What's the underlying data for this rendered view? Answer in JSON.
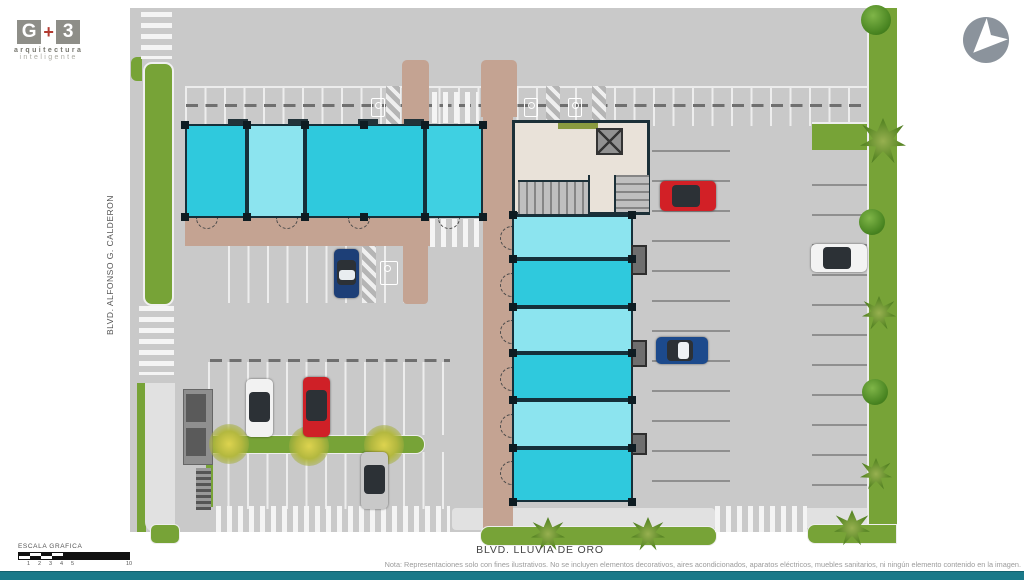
{
  "branding": {
    "logo_g": "G",
    "logo_plus": "+",
    "logo_3": "3",
    "tagline_line1": "arquitectura",
    "tagline_line2": "inteligente"
  },
  "compass": {
    "type": "north-arrow"
  },
  "streets": {
    "left_vertical": "BLVD. ALFONSO G. CALDERON",
    "bottom": "BLVD. LLUVIA DE ORO"
  },
  "scale_bar": {
    "label": "ESCALA GRAFICA",
    "ticks": [
      {
        "label": "1",
        "x": 11
      },
      {
        "label": "2",
        "x": 22
      },
      {
        "label": "3",
        "x": 33
      },
      {
        "label": "4",
        "x": 44
      },
      {
        "label": "5",
        "x": 55
      },
      {
        "label": "10",
        "x": 110
      }
    ]
  },
  "footer_note": "Nota: Representaciones solo con fines ilustrativos. No se incluyen elementos decorativos, aires acondicionados, aparatos eléctricos, muebles sanitarios, ni ningún elemento contenido en la imagen.",
  "palette": {
    "asphalt": "#c9c9c9",
    "grass": "#77a337",
    "walkway_tan": "#c4a392",
    "unit_cyan_dark": "#2fc9dd",
    "unit_cyan_light": "#8ce4ef",
    "wall": "#1c3038",
    "lobby_beige": "#e9e2d9",
    "footer_bar_teal": "#1a7989"
  },
  "site": {
    "west_building": {
      "y": 124,
      "h": 94,
      "wall": "#1c3038",
      "units": [
        {
          "x": 185,
          "w": 62,
          "color": "#2fc9dd"
        },
        {
          "x": 247,
          "w": 58,
          "color": "#8ce4ef"
        },
        {
          "x": 305,
          "w": 120,
          "color": "#2fc9dd"
        },
        {
          "x": 425,
          "w": 58,
          "color": "#3fd0e2"
        }
      ],
      "columns_x": [
        185,
        247,
        305,
        364,
        425,
        483
      ],
      "tabs": [
        {
          "x": 228
        },
        {
          "x": 288
        },
        {
          "x": 358
        },
        {
          "x": 404
        }
      ],
      "door_arcs_x": [
        196,
        276,
        348,
        438
      ]
    },
    "east_building": {
      "x": 512,
      "w": 121,
      "units": [
        {
          "y": 215,
          "h": 44,
          "color": "#8ce4ef"
        },
        {
          "y": 259,
          "h": 48,
          "color": "#2fc9dd"
        },
        {
          "y": 307,
          "h": 46,
          "color": "#8ce4ef"
        },
        {
          "y": 353,
          "h": 47,
          "color": "#2fc9dd"
        },
        {
          "y": 400,
          "h": 48,
          "color": "#8ce4ef"
        },
        {
          "y": 448,
          "h": 54,
          "color": "#2fc9dd"
        }
      ],
      "columns_y": [
        215,
        259,
        307,
        353,
        400,
        448,
        502
      ],
      "utility_boxes": [
        {
          "y": 245,
          "h": 30
        },
        {
          "y": 340,
          "h": 27
        },
        {
          "y": 433,
          "h": 22
        }
      ],
      "door_arcs_y": [
        226,
        273,
        320,
        367,
        414,
        461
      ]
    },
    "cars": [
      {
        "name": "white-car",
        "body": "#f2f2f2",
        "x": 246,
        "y": 379,
        "w": 27,
        "h": 58,
        "dir": "v"
      },
      {
        "name": "red-car",
        "body": "#cf2027",
        "x": 303,
        "y": 377,
        "w": 27,
        "h": 60,
        "dir": "v"
      },
      {
        "name": "blue-car",
        "body": "#1d3f77",
        "roof": "#e9edf0",
        "x": 334,
        "y": 249,
        "w": 25,
        "h": 49,
        "dir": "v"
      },
      {
        "name": "silver-car",
        "body": "#c9c9c9",
        "x": 361,
        "y": 452,
        "w": 27,
        "h": 57,
        "dir": "v"
      },
      {
        "name": "red-car",
        "body": "#d22026",
        "x": 660,
        "y": 181,
        "w": 56,
        "h": 30,
        "dir": "h"
      },
      {
        "name": "white-car",
        "body": "#f3f3f3",
        "x": 811,
        "y": 244,
        "w": 56,
        "h": 28,
        "dir": "h"
      },
      {
        "name": "blue-car",
        "body": "#1c4a8c",
        "roof": "#eef2f5",
        "x": 656,
        "y": 337,
        "w": 52,
        "h": 27,
        "dir": "h"
      }
    ],
    "trees": [
      {
        "t": "bush",
        "x": 876,
        "y": 20,
        "r": 15
      },
      {
        "t": "palm",
        "x": 883,
        "y": 141,
        "r": 23
      },
      {
        "t": "bush",
        "x": 872,
        "y": 222,
        "r": 13
      },
      {
        "t": "palm",
        "x": 879,
        "y": 313,
        "r": 17
      },
      {
        "t": "bush",
        "x": 875,
        "y": 392,
        "r": 13
      },
      {
        "t": "palm",
        "x": 876,
        "y": 474,
        "r": 16
      },
      {
        "t": "palm",
        "x": 548,
        "y": 534,
        "r": 17
      },
      {
        "t": "palm",
        "x": 648,
        "y": 534,
        "r": 17
      },
      {
        "t": "palm",
        "x": 852,
        "y": 528,
        "r": 18
      },
      {
        "t": "ytree",
        "x": 229,
        "y": 444,
        "r": 20
      },
      {
        "t": "ytree",
        "x": 309,
        "y": 446,
        "r": 20
      },
      {
        "t": "ytree",
        "x": 384,
        "y": 445,
        "r": 20
      }
    ],
    "accessible_stalls": [
      {
        "x": 371,
        "y": 98,
        "s": 1
      },
      {
        "x": 524,
        "y": 98,
        "s": 1
      },
      {
        "x": 568,
        "y": 98,
        "s": 1
      },
      {
        "x": 380,
        "y": 261,
        "s": 2
      }
    ]
  }
}
